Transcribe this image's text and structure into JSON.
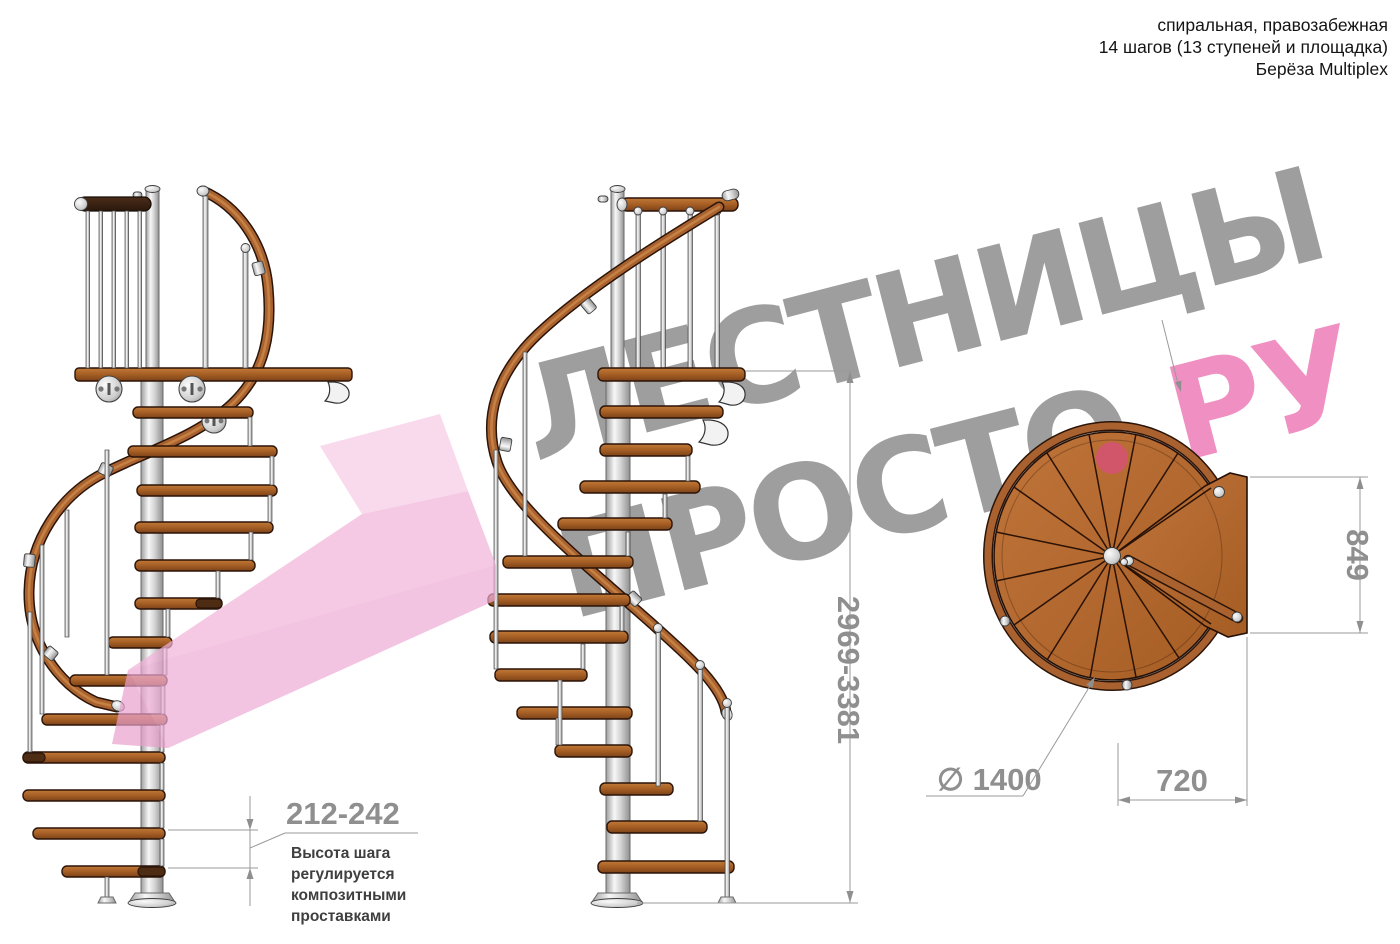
{
  "header": {
    "line1": "спиральная, правозабежная",
    "line2": "14 шагов (13 ступеней и площадка)",
    "line3": "Берёза Multiplex"
  },
  "watermark": {
    "line1": "ЛЕСТНИЦЫ",
    "line2_gray": "ПРОСТО",
    "line2_pink": ".РУ"
  },
  "dimensions": {
    "step_height": "212-242",
    "total_height": "2969-3381",
    "landing_depth": "849",
    "landing_width": "720",
    "diameter": "∅ 1400"
  },
  "note_lines": [
    "Высота шага",
    "регулируется",
    "композитными",
    "проставками"
  ],
  "colors": {
    "wood": "#a9622f",
    "wood_dark": "#2b1408",
    "pole_silver": "#d9d9d9",
    "watermark_gray": "#9e9e9e",
    "accent_pink": "#f08fc1",
    "arrow_pink": "#f2b3da",
    "dimension_gray": "#8f8f8f"
  }
}
